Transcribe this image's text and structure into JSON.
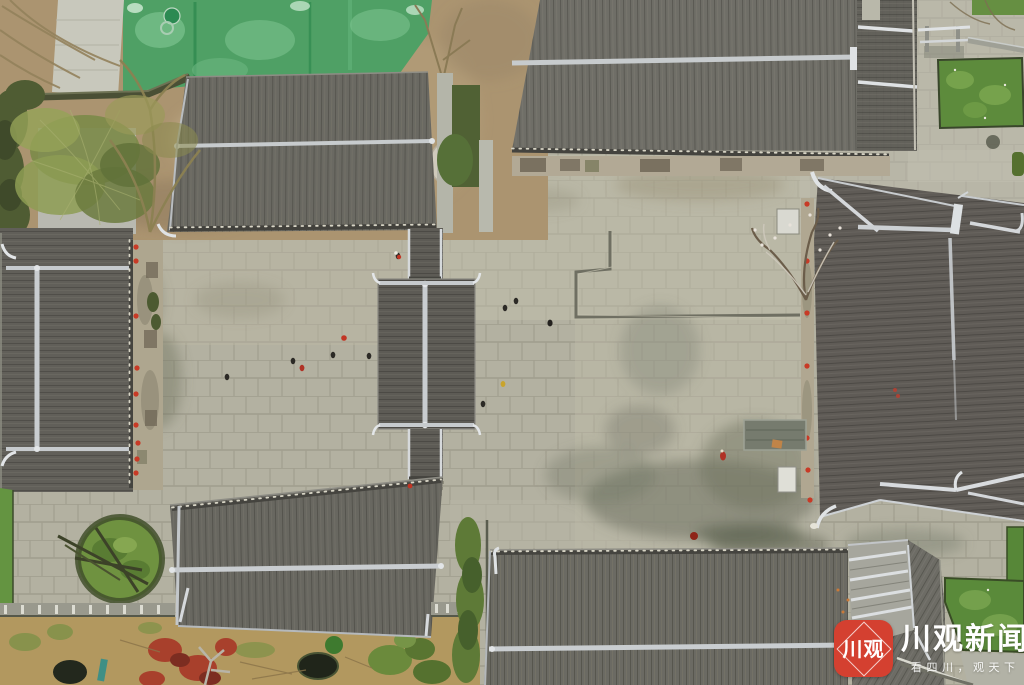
{
  "watermark": {
    "logo_text": "川观",
    "brand_text": "川观新闻",
    "tagline_text": "看四川，观天下",
    "logo_bg_color": "#d44030",
    "text_color": "#ffffff"
  },
  "palette": {
    "roof_gray": "#67665f",
    "roof_dark_hall": "#5f5b56",
    "ridge_light": "#ccd0d3",
    "pavement": "#b3b1a1",
    "courtyard_stain": "#6a6e5c",
    "grass_green": "#5d8b3c",
    "netting_green": "#4fa065",
    "dirt_tan": "#ab9470",
    "garden_tan": "#b2985f",
    "lantern_red": "#c83a26"
  }
}
